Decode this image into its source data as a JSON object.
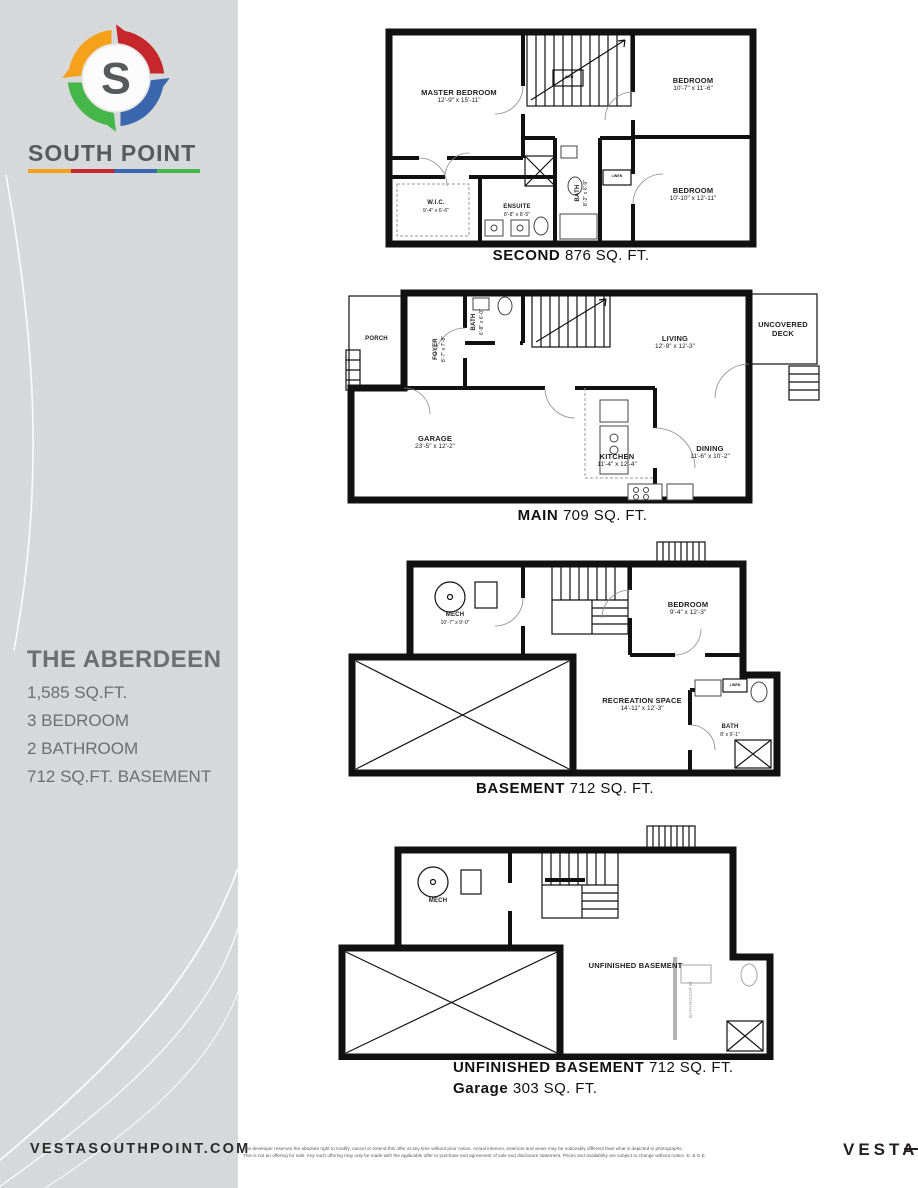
{
  "sidebar": {
    "brand": "SOUTH POINT",
    "logo_letter": "S",
    "plan_name": "THE ABERDEEN",
    "specs": [
      "1,585 SQ.FT.",
      "3 BEDROOM",
      "2 BATHROOM",
      "712 SQ.FT. BASEMENT"
    ],
    "website": "VESTASOUTHPOINT.COM",
    "accent_colors": {
      "orange": "#f5a11c",
      "red": "#c5272d",
      "blue": "#3a66ae",
      "green": "#45b649"
    }
  },
  "plans": {
    "second": {
      "title": "SECOND",
      "area": "876 SQ. FT.",
      "rooms": {
        "master": {
          "name": "MASTER BEDROOM",
          "dims": "12'-9\" x 15'-11\""
        },
        "bedroom2": {
          "name": "BEDROOM",
          "dims": "10'-7\" x 11'-6\""
        },
        "bedroom3": {
          "name": "BEDROOM",
          "dims": "10'-10\" x 12'-11\""
        },
        "wic": {
          "name": "W.I.C.",
          "dims": "9'-4\" x 6'-6\""
        },
        "ensuite": {
          "name": "ENSUITE",
          "dims": "8'-8\" x 8'-5\""
        },
        "bath": {
          "name": "BATH",
          "dims": "8'-2\" x 6'-9\""
        },
        "linen1": "LINEN",
        "linen2": "LINEN"
      }
    },
    "main": {
      "title": "MAIN",
      "area": "709 SQ. FT.",
      "rooms": {
        "porch": {
          "name": "PORCH"
        },
        "foyer": {
          "name": "FOYER",
          "dims": "8'-7\" x 7'-8\""
        },
        "bath": {
          "name": "BATH",
          "dims": "6'-8\" x 6'-0\""
        },
        "living": {
          "name": "LIVING",
          "dims": "12'-9\" x 12'-3\""
        },
        "deck": {
          "line1": "UNCOVERED",
          "line2": "DECK"
        },
        "garage": {
          "name": "GARAGE",
          "dims": "23'-5\" x 12'-2\""
        },
        "kitchen": {
          "name": "KITCHEN",
          "dims": "11'-4\" x 12'-4\""
        },
        "dining": {
          "name": "DINING",
          "dims": "11'-6\" x 10'-2\""
        }
      }
    },
    "basement": {
      "title": "BASEMENT",
      "area": "712 SQ. FT.",
      "rooms": {
        "mech": {
          "name": "MECH",
          "dims": "10'-7\" x 9'-0\""
        },
        "bedroom": {
          "name": "BEDROOM",
          "dims": "9'-4\" x 12'-3\""
        },
        "recreation": {
          "name": "RECREATION SPACE",
          "dims": "14'-11\" x 12'-3\""
        },
        "bath": {
          "name": "BATH",
          "dims": "8' x 9'-1\""
        },
        "linen": "LINEN"
      }
    },
    "unfinished": {
      "title": "UNFINISHED BASEMENT",
      "area": "712 SQ. FT.",
      "title2": "Garage",
      "area2": "303 SQ. FT.",
      "rooms": {
        "mech": {
          "name": "MECH"
        },
        "space": {
          "name": "UNFINISHED BASEMENT"
        },
        "rough": {
          "name": "BATH ROUGH-IN"
        }
      }
    }
  },
  "footer": {
    "disclaimer1": "The developer reserves the absolute right to modify, cancel or extend this offer at any time without prior notice. Actual interiors, exteriors and views may be noticeably different than what is depicted in photographs.",
    "disclaimer2": "This is not an offering for sale. Any such offering may only be made with the applicable offer to purchase and agreement of sale and disclosure statement. Prices and availability are subject to change without notice. E. & O.E.",
    "brand": "VESTA"
  }
}
